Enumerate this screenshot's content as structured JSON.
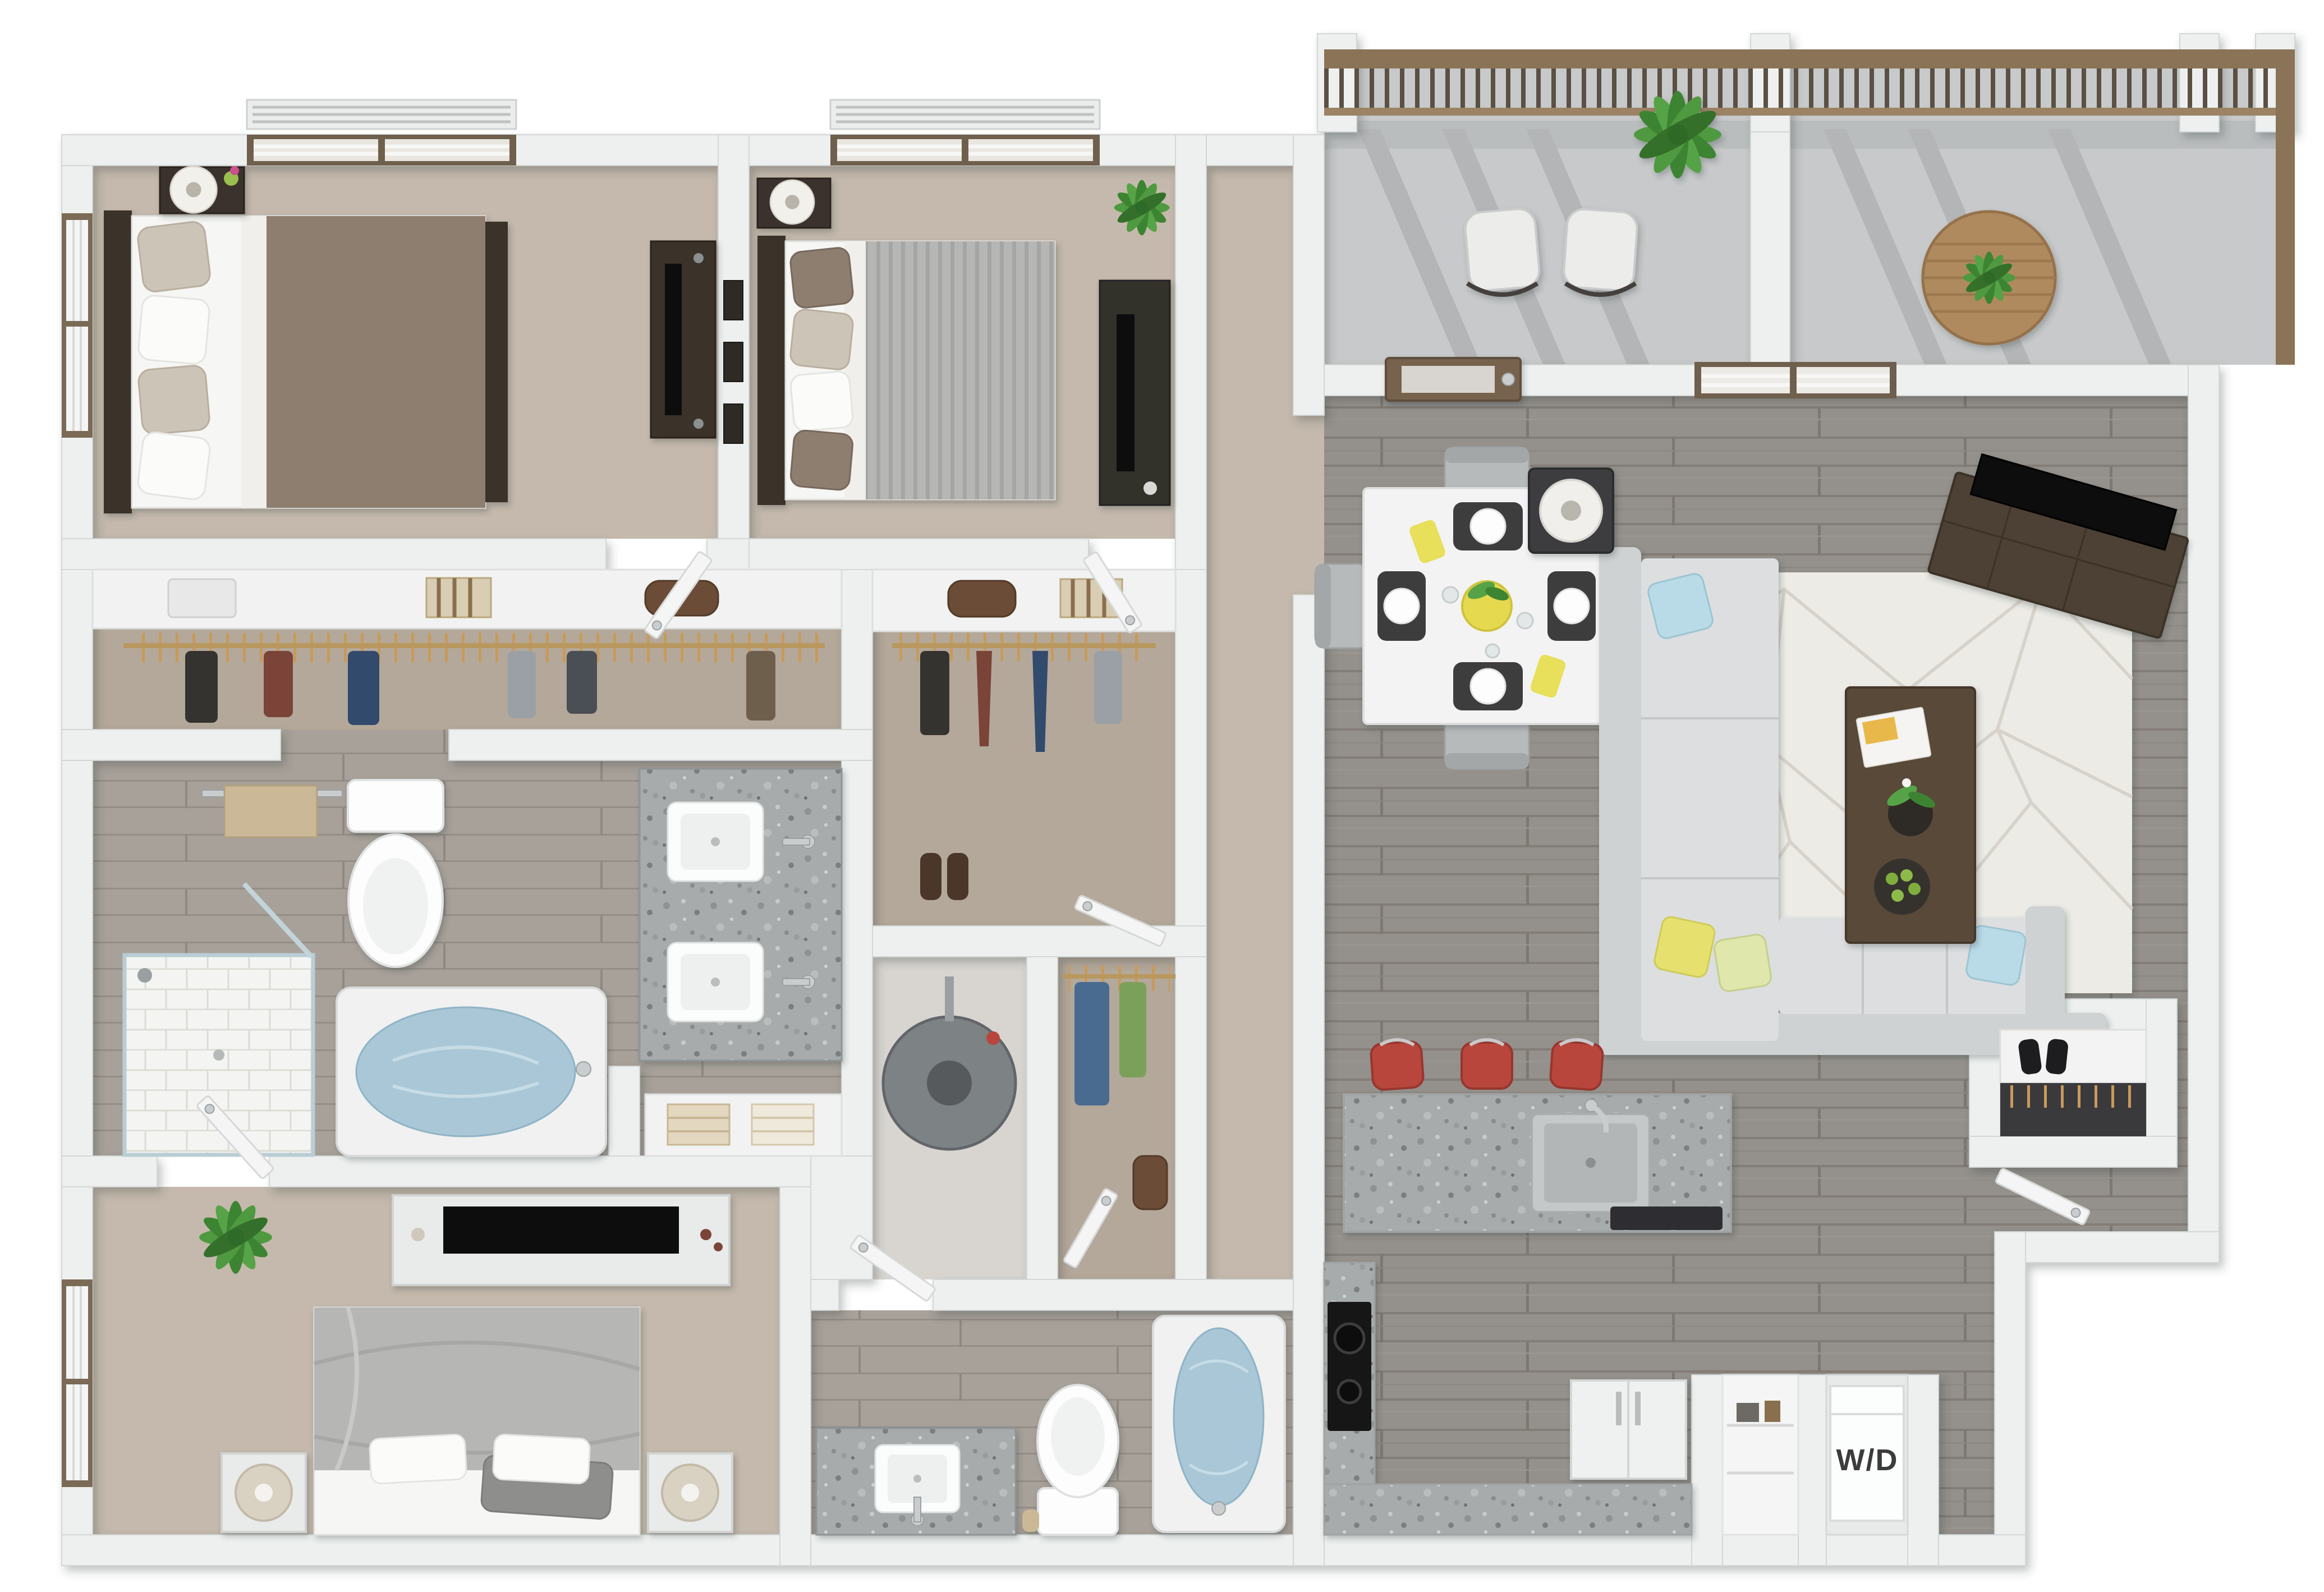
{
  "labels": {
    "washer_dryer": "W/D"
  },
  "palette": {
    "wall": "#edf0ef",
    "wall_stroke": "#d2d7d6",
    "carpet": "#c4b9ac",
    "carpet_dark": "#b4a89a",
    "wood": "#94908b",
    "wood_dark": "#837d77",
    "wood_light": "#a8a19a",
    "utility_floor": "#d8d5d1",
    "balcony_floor": "#c7c9ca",
    "railing": "#8a7356",
    "railing_baluster": "#5a5044",
    "granite": "#a7abac",
    "tile": "#f4f4f2",
    "water": "#a9c7d6",
    "sofa": "#dcdedf",
    "sofa_back": "#cfd2d2",
    "rug": "#ecebe6",
    "rug_line": "#d6d2c9",
    "duvet_brown": "#8d7e70",
    "duvet_gray": "#b6b7b5",
    "sheet_white": "#f6f6f4",
    "accent_stool": "#b8463d",
    "accent_pillow_blue": "#b9dbe7",
    "accent_pillow_yellow": "#e6e16e",
    "plant": "#4f9a40",
    "plant_dark": "#3d8432",
    "door_wood": "#77634e",
    "dark_wood": "#4e4136",
    "tv_black": "#111111",
    "appliance_white": "#fcfdfd",
    "chrome": "#c9cdce"
  },
  "rooms": [
    {
      "name": "bedroom-1",
      "floor": "carpet",
      "furniture": [
        "queen bed with brown duvet and patterned pillows",
        "dark nightstand with lamp and tulip vase",
        "dark dresser with tv",
        "window with blinds left wall",
        "window with blinds top wall"
      ]
    },
    {
      "name": "bedroom-2",
      "floor": "carpet",
      "furniture": [
        "queen bed with gray striped duvet",
        "dark nightstand with lamp",
        "three framed artworks",
        "potted plant",
        "media desk with tv",
        "window with blinds top wall"
      ]
    },
    {
      "name": "bedroom-2-closet",
      "floor": "carpet",
      "furniture": [
        "shelf with duffel bag and striped box",
        "hanging rod with clothes",
        "shoes"
      ]
    },
    {
      "name": "master-bedroom",
      "floor": "carpet",
      "furniture": [
        "king bed with gray duvet",
        "two white nightstands with drum lamps",
        "white dresser with tv",
        "potted plant",
        "window with blinds"
      ]
    },
    {
      "name": "master-bathroom",
      "floor": "wood",
      "furniture": [
        "double granite vanity with two sinks",
        "toilet",
        "towel bar with towel",
        "walk-in tiled shower with glass door",
        "soaking tub with water",
        "linen shelf with towels"
      ]
    },
    {
      "name": "master-closet",
      "floor": "carpet",
      "furniture": [
        "upper shelf with boxes and bag",
        "hanging rod with clothes"
      ]
    },
    {
      "name": "walk-in-closet",
      "floor": "carpet",
      "furniture": [
        "hanging rod with jeans and shirts",
        "white door"
      ]
    },
    {
      "name": "utility-closet",
      "floor": "vinyl",
      "furniture": [
        "water heater"
      ]
    },
    {
      "name": "bathroom-2",
      "floor": "wood",
      "furniture": [
        "granite vanity with sink",
        "toilet with paper roll",
        "soaking tub with water",
        "white door"
      ]
    },
    {
      "name": "hallway",
      "floor": "carpet",
      "furniture": []
    },
    {
      "name": "dining-area",
      "floor": "wood",
      "furniture": [
        "square white table with four place settings",
        "four gray chairs",
        "yellow centerpiece bowl with plant"
      ]
    },
    {
      "name": "living-room",
      "floor": "wood",
      "furniture": [
        "l-shaped sectional sofa with accent pillows",
        "geometric area rug",
        "dark coffee table with magazine, orchid and fruit bowl",
        "angled media console with tv",
        "side table with drum lamp",
        "entry door with frosted glass",
        "window with blinds"
      ]
    },
    {
      "name": "kitchen",
      "floor": "wood",
      "furniture": [
        "granite island with stainless sink and dishwasher",
        "three red bar stools",
        "granite l-counter with black cooktop",
        "refrigerator",
        "white base cabinets"
      ]
    },
    {
      "name": "laundry-closet",
      "floor": "wood",
      "furniture": [
        "stacked washer dryer unit",
        "pantry shelves"
      ]
    },
    {
      "name": "coat-closet",
      "floor": "wood",
      "furniture": [
        "shelf with black shoes",
        "hanging rod with clothes",
        "white door"
      ]
    },
    {
      "name": "balcony",
      "floor": "concrete",
      "furniture": [
        "two patio chairs",
        "potted floor plant",
        "round wood table with plant",
        "wood railing with balusters and white posts",
        "privacy wall"
      ]
    }
  ]
}
